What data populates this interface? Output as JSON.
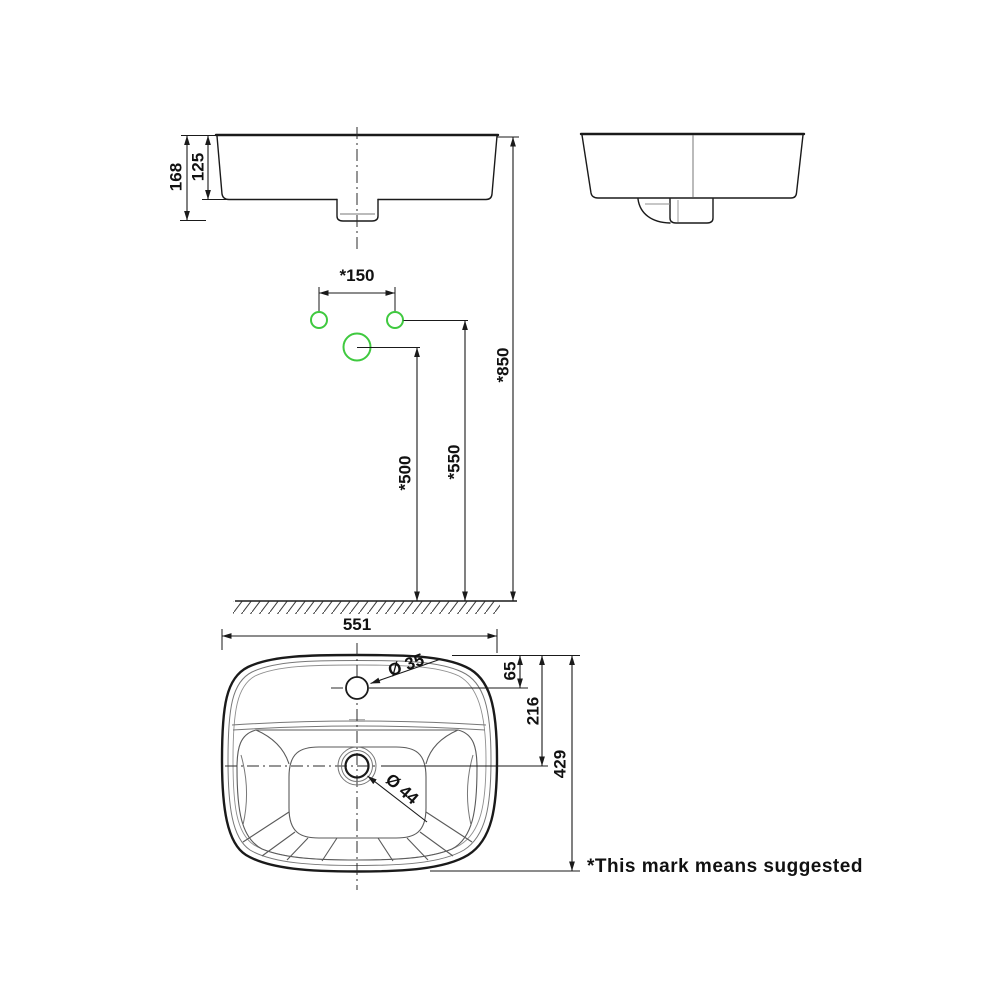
{
  "front_view": {
    "overall_height": "168",
    "bowl_height": "125"
  },
  "installation": {
    "faucet_spacing": "*150",
    "rim_height": "*850",
    "supply_height": "*550",
    "drain_height": "*500"
  },
  "plan_view": {
    "overall_width": "551",
    "overall_depth": "429",
    "faucet_offset": "65",
    "drain_offset": "216",
    "faucet_hole_dia": "Ø 35",
    "drain_hole_dia": "Ø 44"
  },
  "footnote": "*This mark means suggested",
  "colors": {
    "accent_green": "#3fc93f",
    "line_black": "#1a1a1a"
  }
}
